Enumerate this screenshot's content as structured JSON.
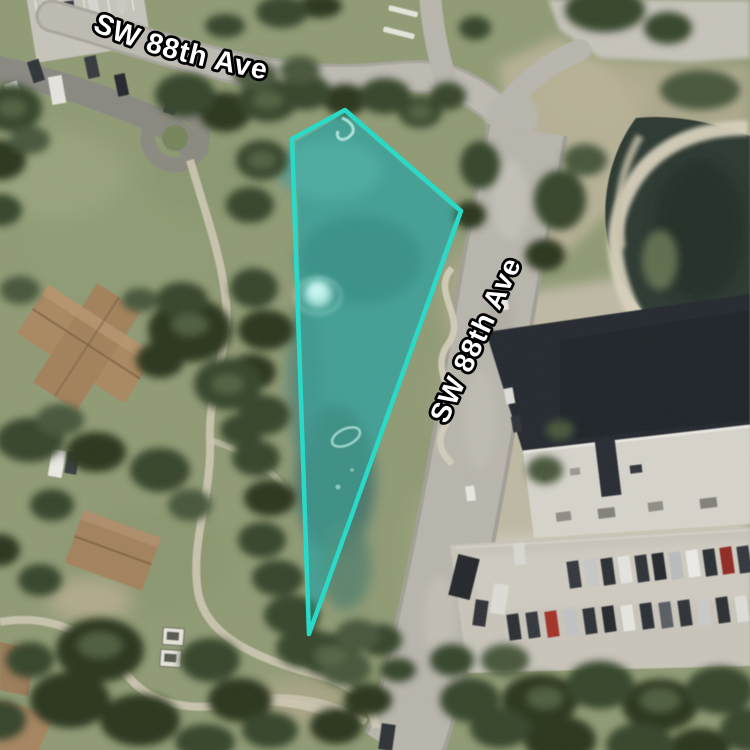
{
  "map": {
    "view": "aerial-satellite",
    "street_labels": [
      {
        "text": "SW 88th Ave",
        "position": "top-curved"
      },
      {
        "text": "SW 88th Ave",
        "position": "right-diagonal"
      }
    ],
    "label_style": {
      "text_color": "#ffffff",
      "outline_color": "#000000"
    },
    "parcel_highlight": {
      "stroke_color": "#2adac9",
      "fill_color": "rgba(42,218,201,0.26)",
      "vertices_px": [
        [
          292,
          139
        ],
        [
          345,
          110
        ],
        [
          461,
          211
        ],
        [
          309,
          634
        ]
      ]
    }
  }
}
